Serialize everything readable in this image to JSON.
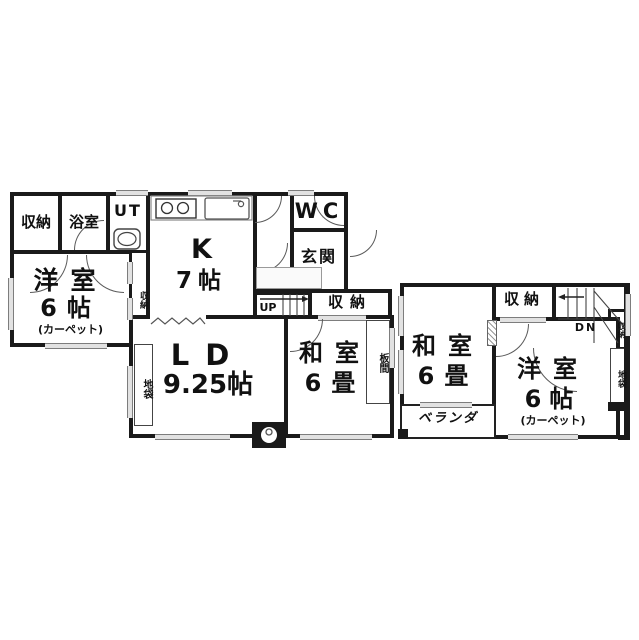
{
  "title": "2-story house floor plan",
  "colors": {
    "wall": "#1a1a1a",
    "window_fill": "#e2e2e2",
    "background": "#ffffff"
  },
  "floor1": {
    "labels": {
      "storage_tl": "収納",
      "bathroom": "浴室",
      "utility": "UT",
      "kitchen_l1": "K",
      "kitchen_l2": "7帖",
      "wc": "WC",
      "entrance": "玄関",
      "western_room_l1": "洋室",
      "western_room_l2": "6帖",
      "western_room_note": "(カーペット)",
      "western_room_closet": "収納",
      "stairs_up": "UP",
      "storage_by_stairs": "収納",
      "living_l1": "LD",
      "living_l2": "9.25帖",
      "japanese_room_l1": "和室",
      "japanese_room_l2": "6畳",
      "wood_floor_strip": "板間",
      "floor_cabinet_strip": "地袋"
    }
  },
  "floor2": {
    "labels": {
      "japanese_room_l1": "和室",
      "japanese_room_l2": "6畳",
      "storage_top": "収納",
      "stairs_down": "DN",
      "storage_side": "収納",
      "floor_cabinet_strip": "地袋",
      "western_room_l1": "洋室",
      "western_room_l2": "6帖",
      "western_room_note": "(カーペット)",
      "veranda": "ベランダ"
    }
  }
}
